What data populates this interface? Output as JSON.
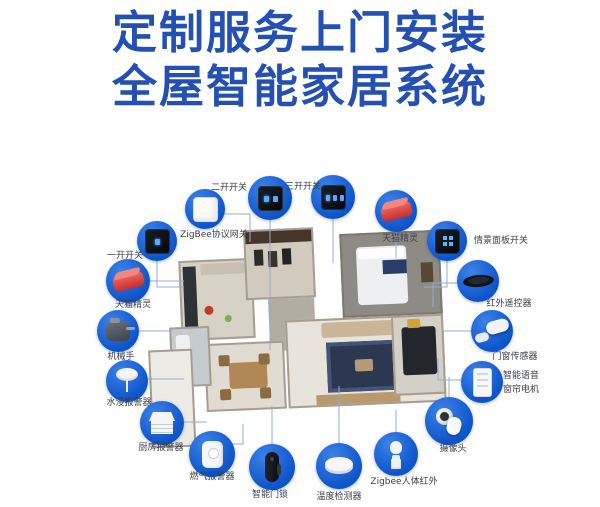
{
  "title": {
    "line1": "定制服务上门安装",
    "line2": "全屋智能家居系统"
  },
  "colors": {
    "title_blue": "#2350b2",
    "circle_blue": "#0d53c9",
    "circle_highlight": "#3b82e8",
    "connector_line": "#93abd3",
    "label_text": "#3b3f46",
    "genie_red": "#d0393c"
  },
  "floor_plan": {
    "type": "isometric-apartment-render"
  },
  "devices": [
    {
      "name": "switch-two-gang",
      "label": "二开开关",
      "icon": "switch2",
      "cx": 270,
      "cy": 198,
      "r": 22,
      "lx": 247,
      "ly": 180,
      "align": "right",
      "line": [
        [
          270,
          220
        ],
        [
          270,
          350
        ]
      ]
    },
    {
      "name": "switch-three-gang",
      "label": "三开开关",
      "icon": "switch3",
      "cx": 333,
      "cy": 197,
      "r": 22,
      "lx": 303,
      "ly": 179,
      "align": "center",
      "line": [
        [
          333,
          219
        ],
        [
          333,
          263
        ]
      ]
    },
    {
      "name": "zigbee-gateway",
      "label": "ZigBee协议网关",
      "icon": "gateway",
      "cx": 205,
      "cy": 209,
      "r": 20,
      "lx": 214,
      "ly": 227,
      "align": "center",
      "line": [
        [
          223,
          214
        ],
        [
          250,
          214
        ],
        [
          250,
          242
        ]
      ]
    },
    {
      "name": "tmall-genie-right",
      "label": "天猫精灵",
      "icon": "genie",
      "cx": 396,
      "cy": 211,
      "r": 21,
      "lx": 400,
      "ly": 231,
      "align": "center",
      "line": [
        [
          396,
          232
        ],
        [
          396,
          258
        ]
      ]
    },
    {
      "name": "scene-panel-switch",
      "label": "情景面板开关",
      "icon": "scenepanel",
      "cx": 447,
      "cy": 241,
      "r": 20,
      "lx": 474,
      "ly": 233,
      "align": "left",
      "line": [
        [
          447,
          261
        ],
        [
          447,
          287
        ],
        [
          424,
          287
        ]
      ]
    },
    {
      "name": "infrared-remote",
      "label": "红外遥控器",
      "icon": "irremote",
      "cx": 478,
      "cy": 281,
      "r": 21,
      "lx": 509,
      "ly": 296,
      "align": "center",
      "line": [
        [
          457,
          283
        ],
        [
          433,
          283
        ],
        [
          433,
          307
        ]
      ]
    },
    {
      "name": "door-window-sensor",
      "label": "门窗传感器",
      "icon": "doorsensor",
      "cx": 492,
      "cy": 331,
      "r": 21,
      "lx": 515,
      "ly": 349,
      "align": "center",
      "line": [
        [
          471,
          331
        ],
        [
          442,
          331
        ]
      ]
    },
    {
      "name": "smart-voice-curtain-motor",
      "label_lines": [
        "智能语音",
        "窗帘电机"
      ],
      "icon": "curtain",
      "cx": 482,
      "cy": 382,
      "r": 21,
      "lx": 503,
      "ly": 368,
      "align": "left",
      "line": [
        [
          461,
          380
        ],
        [
          438,
          380
        ],
        [
          438,
          358
        ]
      ]
    },
    {
      "name": "camera",
      "label": "摄像头",
      "icon": "camera",
      "cx": 449,
      "cy": 421,
      "r": 24,
      "lx": 453,
      "ly": 441,
      "align": "center",
      "line": [
        [
          449,
          397
        ],
        [
          449,
          377
        ]
      ]
    },
    {
      "name": "switch-one-gang",
      "label": "一开开关",
      "icon": "switch1",
      "cx": 157,
      "cy": 241,
      "r": 20,
      "lx": 143,
      "ly": 248,
      "align": "right",
      "line": [
        [
          157,
          261
        ],
        [
          157,
          287
        ],
        [
          184,
          287
        ]
      ]
    },
    {
      "name": "tmall-genie-left",
      "label": "天猫精灵",
      "icon": "genie",
      "cx": 128,
      "cy": 281,
      "r": 22,
      "lx": 133,
      "ly": 297,
      "align": "center",
      "line": [
        [
          150,
          281
        ],
        [
          184,
          281
        ]
      ]
    },
    {
      "name": "robot-hand",
      "label": "机械手",
      "icon": "robothand",
      "cx": 118,
      "cy": 331,
      "r": 21,
      "lx": 121,
      "ly": 349,
      "align": "center",
      "line": [
        [
          139,
          331
        ],
        [
          172,
          331
        ]
      ]
    },
    {
      "name": "water-leak-alarm",
      "label": "水浸报警器",
      "icon": "water",
      "cx": 127,
      "cy": 381,
      "r": 21,
      "lx": 129,
      "ly": 395,
      "align": "center",
      "line": [
        [
          148,
          379
        ],
        [
          184,
          379
        ]
      ]
    },
    {
      "name": "kitchen-alarm",
      "label": "厨房报警器",
      "icon": "kitchenalarm",
      "cx": 162,
      "cy": 423,
      "r": 22,
      "lx": 161,
      "ly": 440,
      "align": "center",
      "line": [
        [
          184,
          422
        ],
        [
          207,
          422
        ]
      ]
    },
    {
      "name": "gas-alarm",
      "label": "燃气报警器",
      "icon": "gas",
      "cx": 212,
      "cy": 454,
      "r": 23,
      "lx": 212,
      "ly": 469,
      "align": "center",
      "line": [
        [
          228,
          444
        ],
        [
          243,
          444
        ],
        [
          243,
          424
        ]
      ]
    },
    {
      "name": "smart-door-lock",
      "label": "智能门锁",
      "icon": "lock",
      "cx": 272,
      "cy": 467,
      "r": 23,
      "lx": 270,
      "ly": 487,
      "align": "center",
      "line": [
        [
          272,
          444
        ],
        [
          272,
          406
        ]
      ]
    },
    {
      "name": "temperature-detector",
      "label": "温度检测器",
      "icon": "temp",
      "cx": 339,
      "cy": 466,
      "r": 23,
      "lx": 339,
      "ly": 489,
      "align": "center",
      "line": [
        [
          339,
          443
        ],
        [
          339,
          386
        ]
      ]
    },
    {
      "name": "zigbee-body-infrared",
      "label": "Zigbee人体红外",
      "icon": "pir",
      "cx": 396,
      "cy": 454,
      "r": 22,
      "lx": 404,
      "ly": 474,
      "align": "center",
      "line": [
        [
          396,
          432
        ],
        [
          396,
          410
        ]
      ]
    }
  ]
}
